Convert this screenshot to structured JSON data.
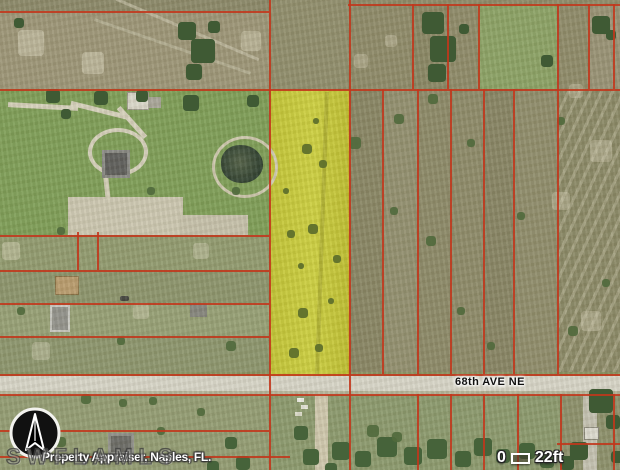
{
  "map": {
    "road_label": "68th AVE NE",
    "scale_bar": {
      "start_label": "0",
      "end_label": "22ft"
    },
    "watermark": "SWFLAMLS",
    "attribution": "Property Appraiser, Naples, FL.",
    "icons": {
      "north_arrow": "▲",
      "scale_segment": "▭"
    },
    "colors": {
      "parcel_line_red": "#C2371B",
      "highlight_yellow": "#C7CA3B",
      "road_gray": "#D7D5C8",
      "north_arrow_disc": "#111111"
    }
  }
}
